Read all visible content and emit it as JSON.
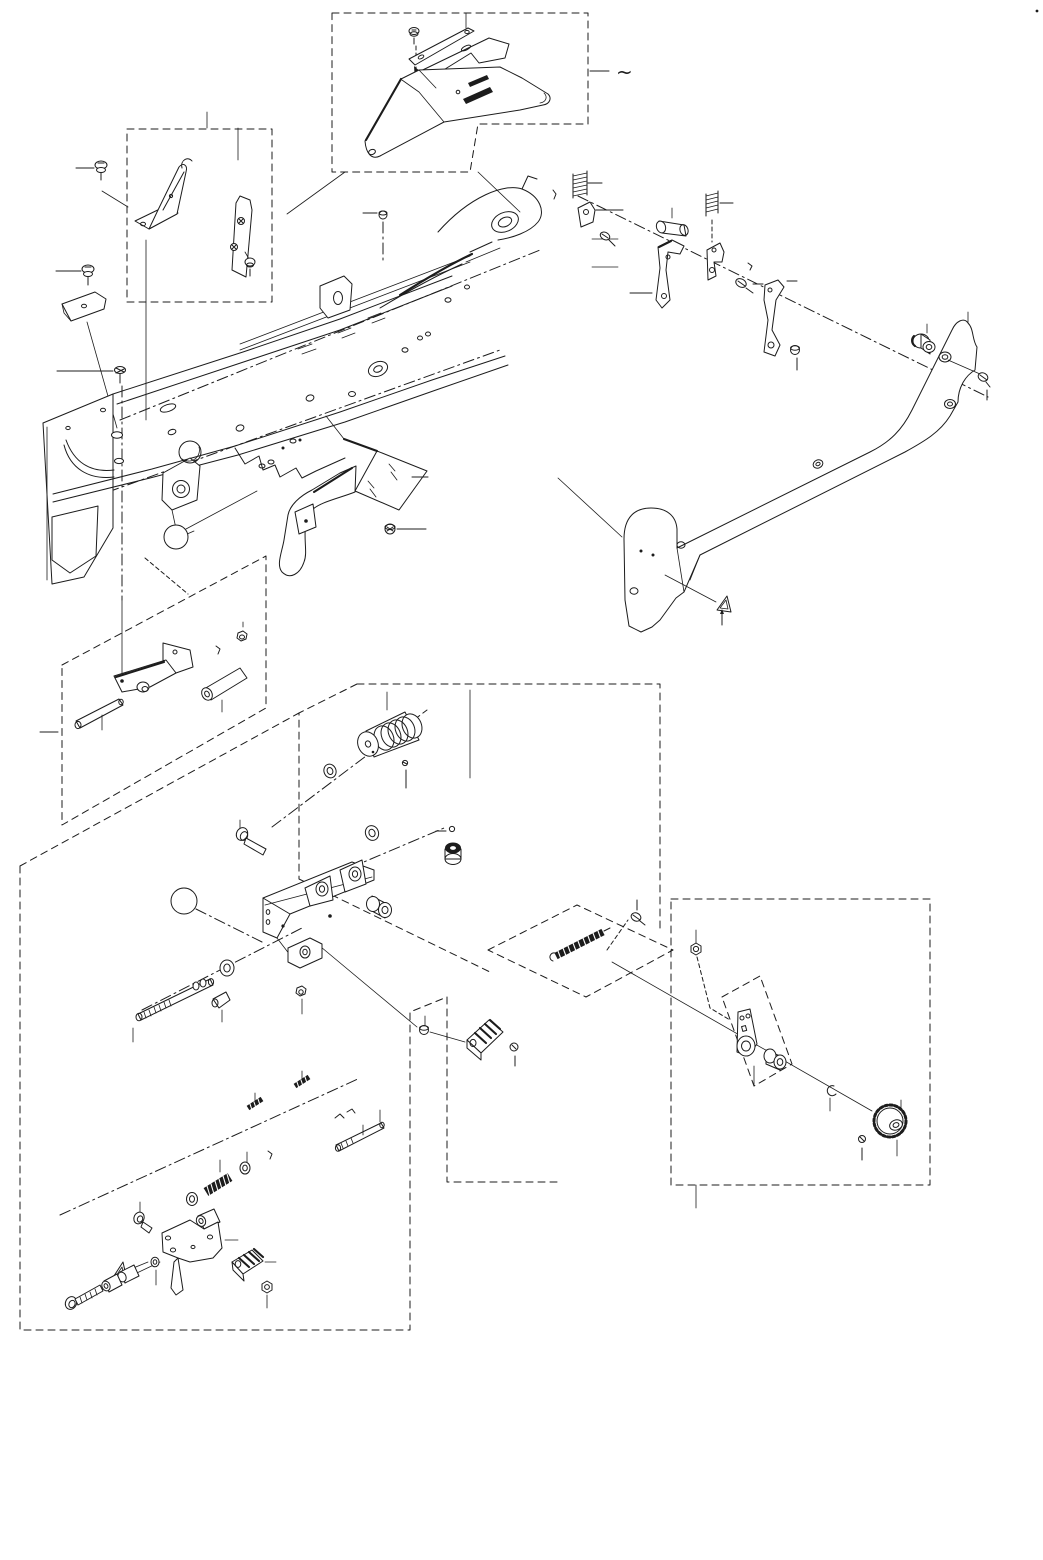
{
  "figure": {
    "type": "exploded-parts-diagram",
    "description": "black line-art exploded view of a mechanical feeder frame with grouped sub-assemblies in dashed callout boxes",
    "background_color": "#ffffff",
    "line_color": "#1c1c1c",
    "tilde_label": "~",
    "caution_triangle_count": 2,
    "callout_boxes": [
      {
        "id": "top-guide-box",
        "shape": "stepped rectangle",
        "contents": [
          "screw",
          "slide-bar",
          "notched-plate",
          "guide-cover"
        ]
      },
      {
        "id": "upper-left-bracket-box",
        "shape": "rectangle",
        "contents": [
          "gusset-bracket",
          "strip-bracket",
          "screws"
        ]
      },
      {
        "id": "mid-left-link-box",
        "shape": "parallelogram",
        "contents": [
          "crank-lever",
          "pivot-pin",
          "roller-cylinder",
          "nut",
          "small-pin"
        ]
      },
      {
        "id": "central-knob-box",
        "shape": "open rectangle",
        "contents": [
          "knurled-knob",
          "set-screw",
          "washers",
          "bushing",
          "shoulder-bolt"
        ]
      },
      {
        "id": "tension-spring-box",
        "shape": "rhombus",
        "contents": [
          "extension-spring",
          "spring-screw"
        ]
      },
      {
        "id": "gear-box",
        "shape": "rectangle",
        "contents": [
          "nut",
          "link-lever",
          "roller",
          "c-clip",
          "ratchet-gear",
          "set-screw"
        ]
      },
      {
        "id": "gear-inner-box",
        "shape": "tilted rectangle",
        "contents": [
          "link-lever"
        ]
      },
      {
        "id": "bottom-left-lever-box",
        "shape": "pentagon",
        "contents": [
          "socket-bolt",
          "spacers",
          "caution-triangle",
          "coil-spring",
          "latch-bracket",
          "serrated-block",
          "nut",
          "clevis-rod",
          "small-springs"
        ]
      }
    ],
    "loose_parts": [
      "hex-screw",
      "hex-screw",
      "cover-plate-small",
      "flat-screw",
      "compression-spring",
      "latch-plate",
      "roller-cylinder",
      "compression-spring-2",
      "bent-lever",
      "latch-bracket-2",
      "shoulder-screws",
      "curved-lever",
      "rubber-roller",
      "side-cover-plate",
      "flange-screw",
      "ball-knob",
      "feed-bracket",
      "threaded-shaft",
      "washers",
      "serrated-block-2"
    ],
    "main_part": "feeder-main-frame"
  }
}
